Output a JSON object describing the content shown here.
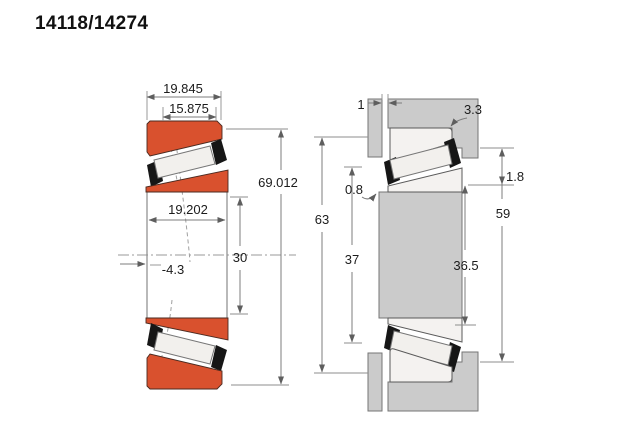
{
  "title": "14118/14274",
  "colors": {
    "ring_accent": "#d9512e",
    "housing_gray": "#cbcbcb",
    "dimension_line": "#7c7c7c"
  },
  "left_view": {
    "description": "bearing-cross-section",
    "dims": {
      "overall_width": "19.845",
      "cup_width": "15.875",
      "cone_width": "19.202",
      "bore_diameter": "30",
      "outer_diameter": "69.012",
      "effective_center": "-4.3"
    }
  },
  "right_view": {
    "description": "mounting-abutment-section",
    "dims": {
      "front_face_gap": "1",
      "housing_fillet": "3.3",
      "shaft_fillet": "0.8",
      "housing_shoulder_diameter": "63",
      "shaft_shoulder_diameter": "37",
      "cone_backface_diameter": "36.5",
      "cup_backface_diameter": "59",
      "backface_standout": "1.8"
    }
  }
}
